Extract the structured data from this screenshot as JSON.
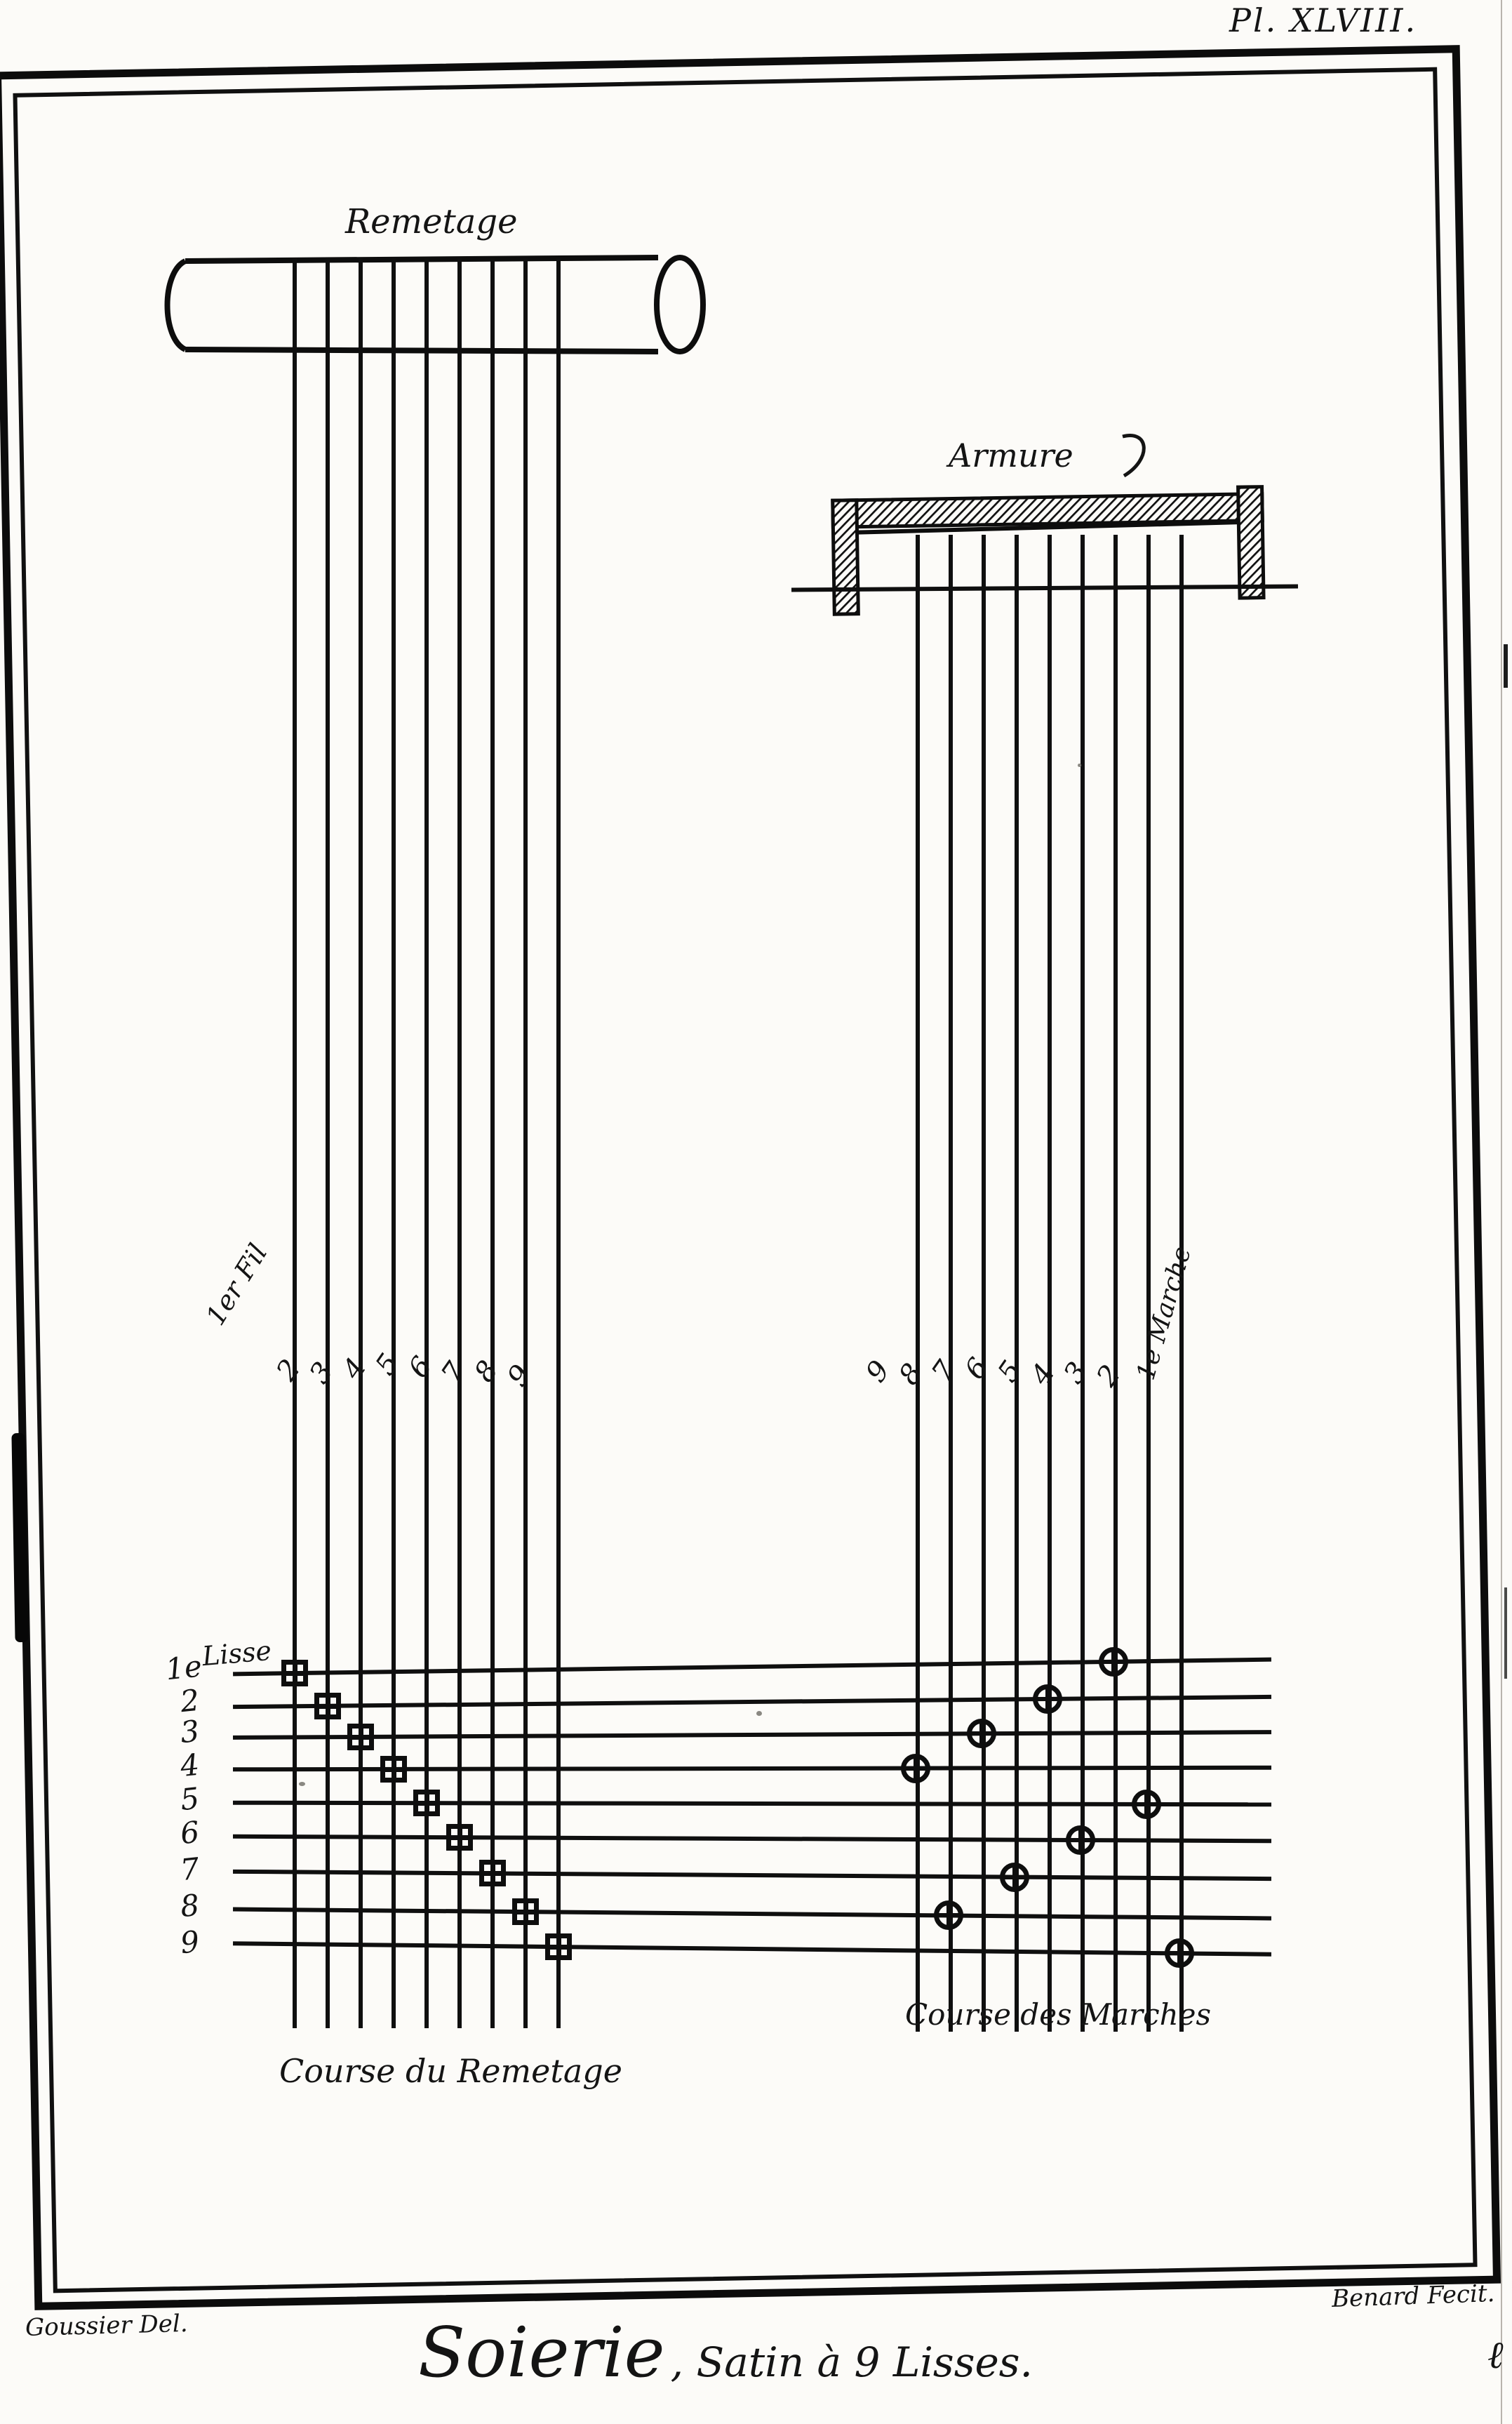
{
  "plate": {
    "number": "Pl. XLVIII.",
    "title_script": "Soierie",
    "title_rest": ", Satin à 9 Lisses.",
    "credit_left": "Goussier Del.",
    "credit_right": "Benard Fecit.",
    "corner_mark": "ℓ"
  },
  "remetage": {
    "label": "Remetage",
    "caption": "Course du Remetage",
    "first_fil_label": "1er Fil",
    "fil_labels": [
      "2",
      "3",
      "4",
      "5",
      "6",
      "7",
      "8",
      "9"
    ]
  },
  "armure": {
    "label": "Armure",
    "caption": "Course des Marches",
    "first_marche_label": "1e Marche",
    "marche_labels": [
      "9",
      "8",
      "7",
      "6",
      "5",
      "4",
      "3",
      "2"
    ]
  },
  "lisses": {
    "label": "Lisse",
    "row_labels": [
      "1e",
      "2",
      "3",
      "4",
      "5",
      "6",
      "7",
      "8",
      "9"
    ]
  },
  "weave": {
    "remetage_points_lisse_fil": [
      [
        1,
        1
      ],
      [
        2,
        2
      ],
      [
        3,
        3
      ],
      [
        4,
        4
      ],
      [
        5,
        5
      ],
      [
        6,
        6
      ],
      [
        7,
        7
      ],
      [
        8,
        8
      ],
      [
        9,
        9
      ]
    ],
    "marche_points_lisse_marche": [
      [
        1,
        3
      ],
      [
        2,
        5
      ],
      [
        3,
        7
      ],
      [
        4,
        9
      ],
      [
        5,
        2
      ],
      [
        6,
        4
      ],
      [
        7,
        6
      ],
      [
        8,
        8
      ],
      [
        9,
        1
      ]
    ]
  }
}
